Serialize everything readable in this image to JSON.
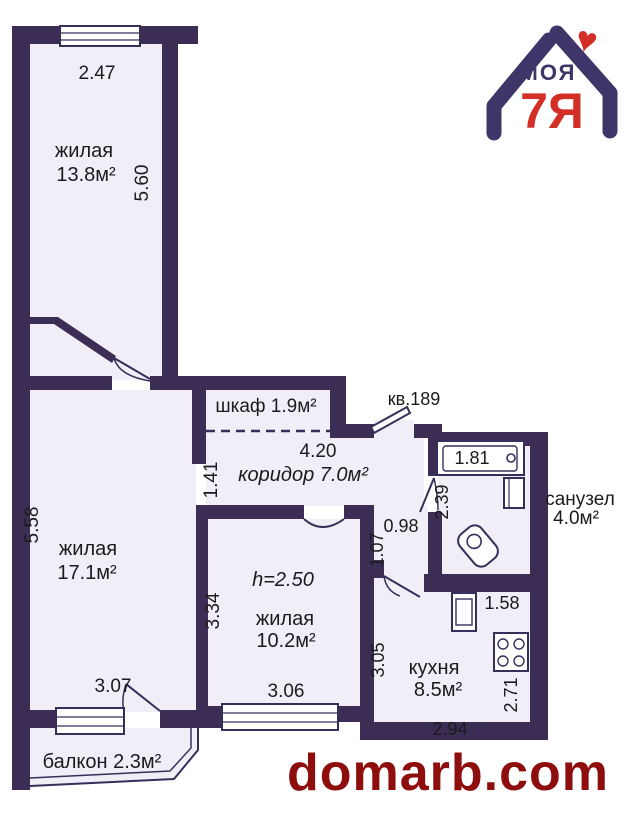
{
  "brand": {
    "watermark": "domarb.com",
    "logo_text_top": "МОЯ",
    "logo_text_main": "7Я",
    "logo_heart": "♥"
  },
  "apartment_label": "кв.189",
  "rooms": {
    "living_top": {
      "name": "жилая",
      "area": "13.8м²"
    },
    "living_left": {
      "name": "жилая",
      "area": "17.1м²"
    },
    "living_small": {
      "name": "жилая",
      "area": "10.2м²",
      "ceiling": "h=2.50"
    },
    "closet": {
      "label": "шкаф 1.9м²"
    },
    "corridor": {
      "label": "коридор 7.0м²"
    },
    "bathroom": {
      "name": "санузел",
      "area": "4.0м²"
    },
    "kitchen": {
      "name": "кухня",
      "area": "8.5м²"
    },
    "balcony": {
      "label": "балкон 2.3м²"
    }
  },
  "dimensions": {
    "living_top_width": "2.47",
    "living_top_height": "5.60",
    "living_left_height": "5.58",
    "living_left_width": "3.07",
    "corridor_width": "4.20",
    "corridor_left": "1.41",
    "passage_width": "0.98",
    "passage_height": "1.07",
    "bathroom_width": "1.81",
    "bathroom_height": "2.39",
    "living_small_height": "3.34",
    "living_small_width": "3.06",
    "kitchen_top": "1.58",
    "kitchen_height": "3.05",
    "kitchen_right": "2.71",
    "kitchen_width": "2.94"
  },
  "colors": {
    "wall": "#3b2d54",
    "floor": "#f2eef8",
    "line": "#35305a",
    "text": "#1b1b1b",
    "brand_navy": "#3f3569",
    "brand_red": "#d42f26",
    "watermark_red": "#8e0e0e"
  }
}
